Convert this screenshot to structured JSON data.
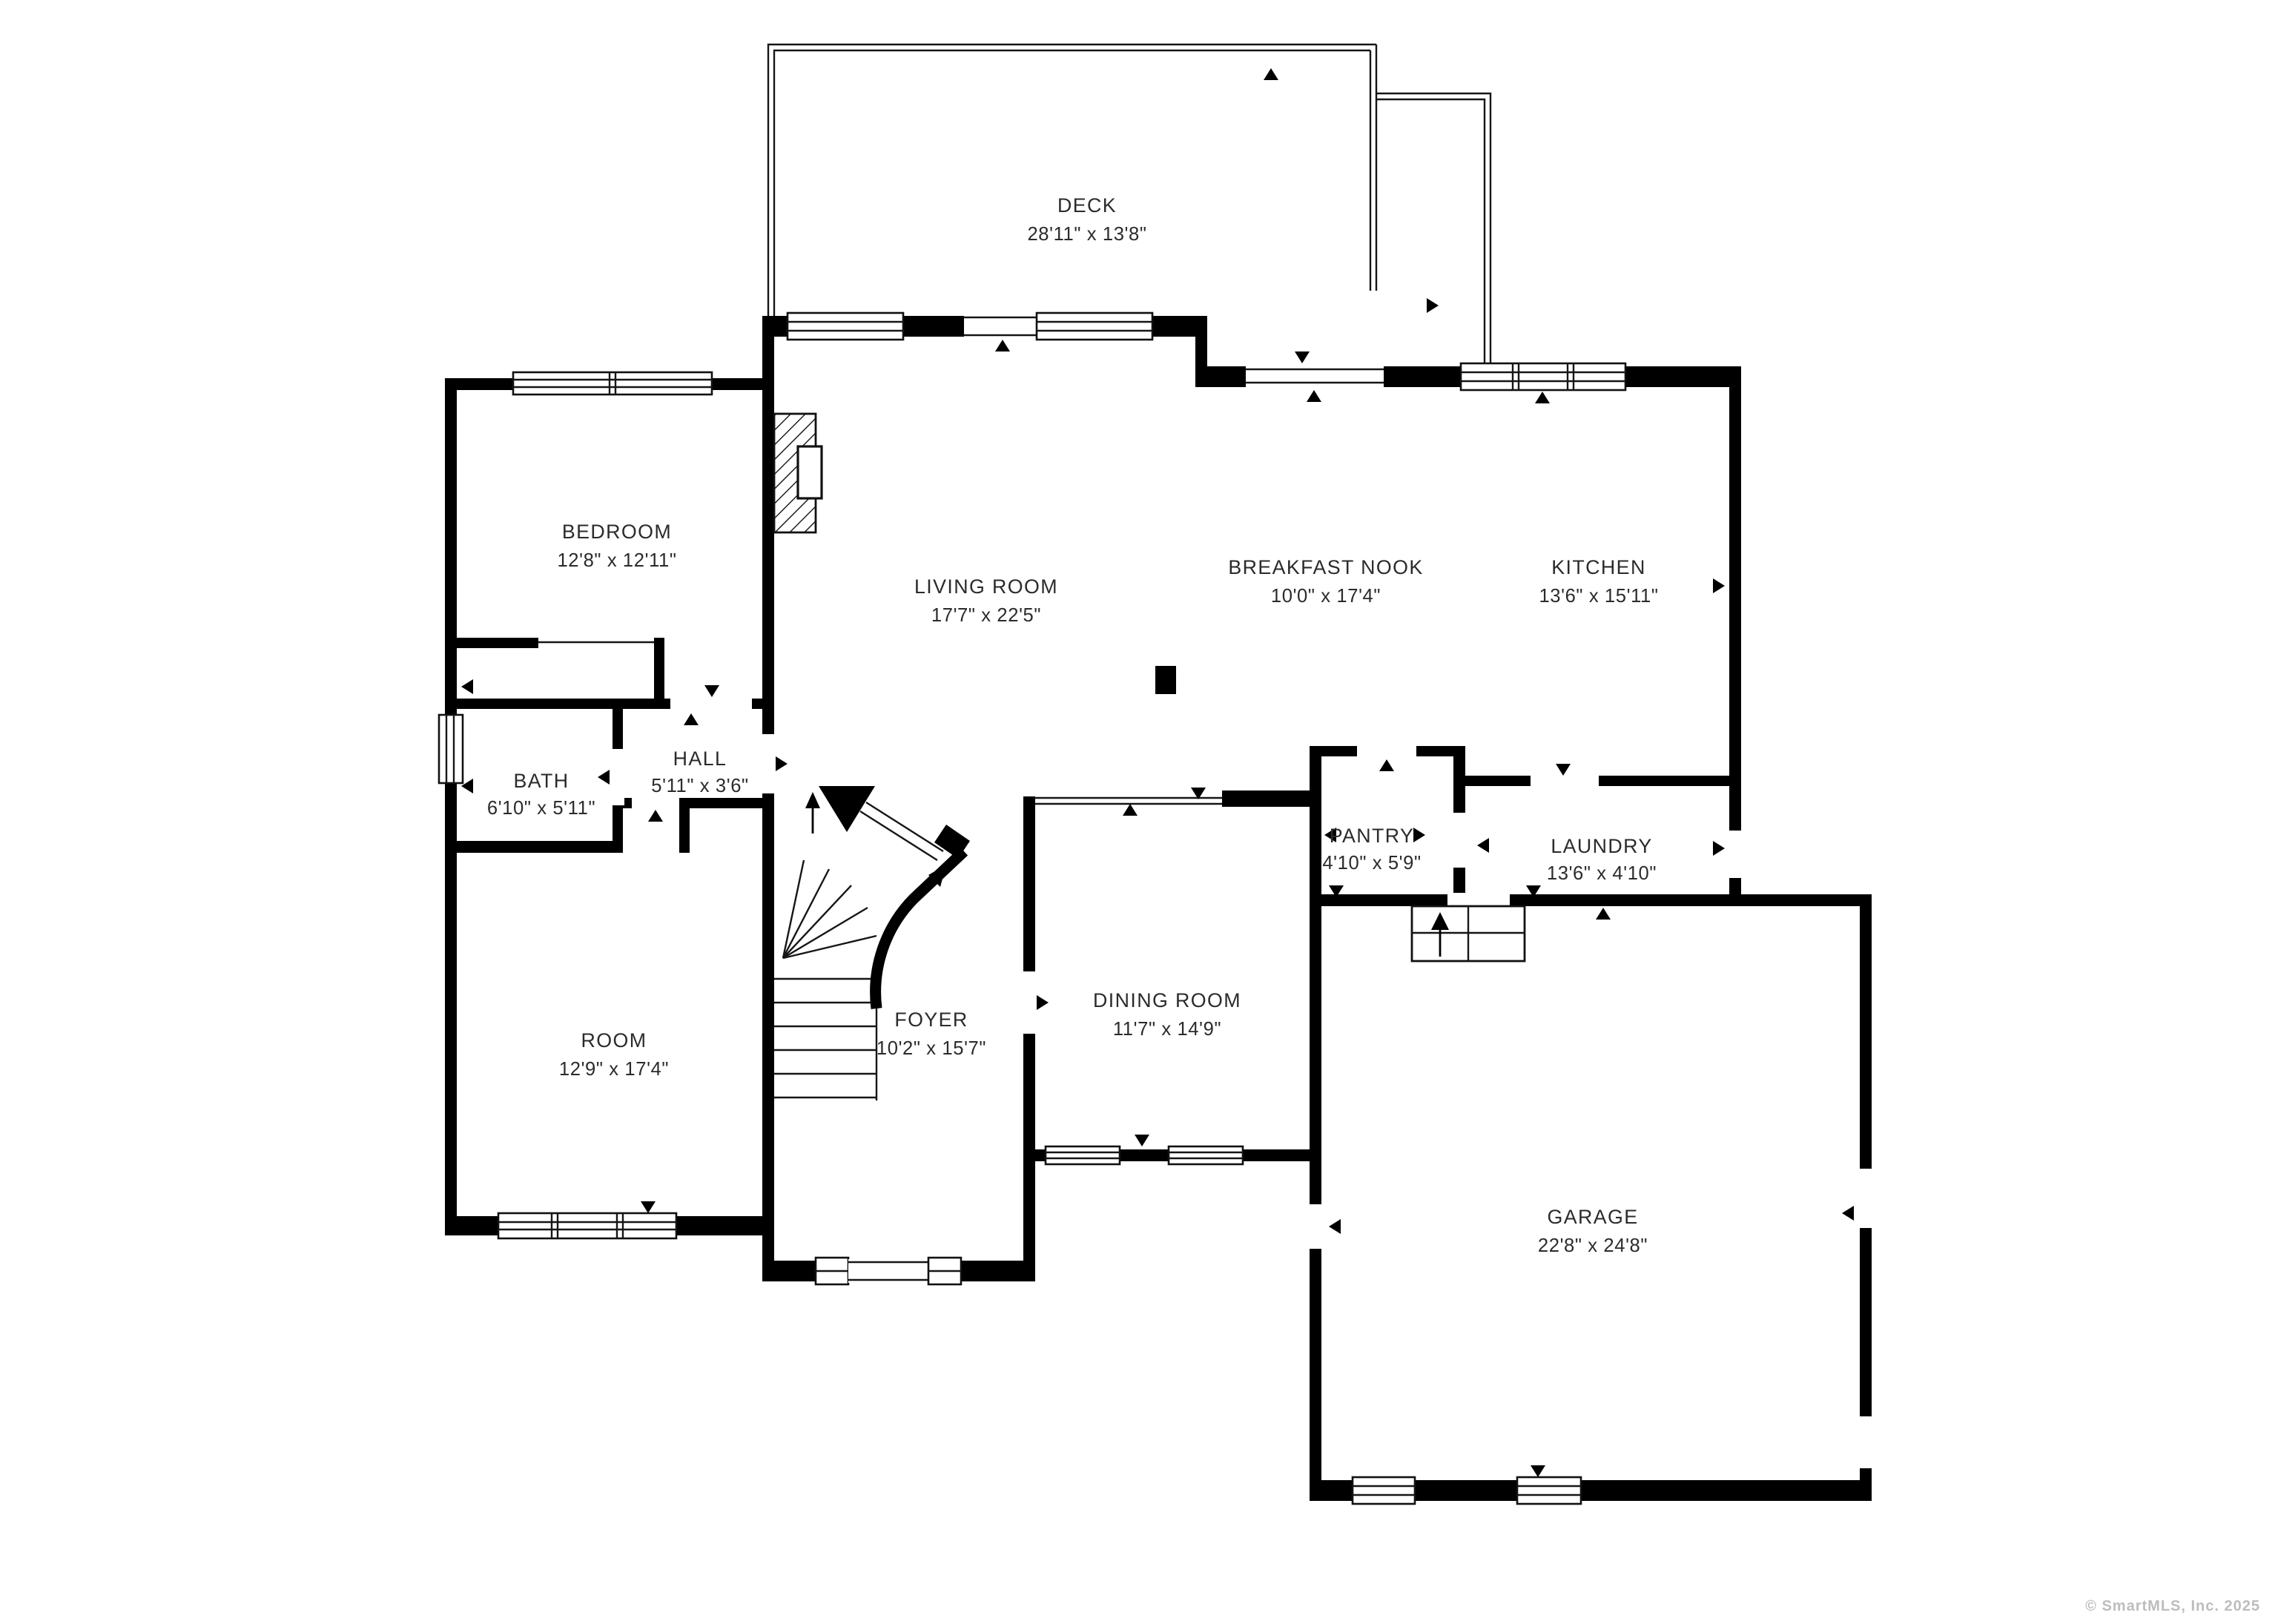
{
  "rooms": [
    {
      "name": "DECK",
      "dims": "28'11\" x 13'8\""
    },
    {
      "name": "BEDROOM",
      "dims": "12'8\" x 12'11\""
    },
    {
      "name": "LIVING ROOM",
      "dims": "17'7\" x 22'5\""
    },
    {
      "name": "BREAKFAST NOOK",
      "dims": "10'0\" x 17'4\""
    },
    {
      "name": "KITCHEN",
      "dims": "13'6\" x 15'11\""
    },
    {
      "name": "BATH",
      "dims": "6'10\" x 5'11\""
    },
    {
      "name": "HALL",
      "dims": "5'11\" x 3'6\""
    },
    {
      "name": "PANTRY",
      "dims": "4'10\" x 5'9\""
    },
    {
      "name": "LAUNDRY",
      "dims": "13'6\" x 4'10\""
    },
    {
      "name": "ROOM",
      "dims": "12'9\" x 17'4\""
    },
    {
      "name": "FOYER",
      "dims": "10'2\" x 15'7\""
    },
    {
      "name": "DINING ROOM",
      "dims": "11'7\" x 14'9\""
    },
    {
      "name": "GARAGE",
      "dims": "22'8\" x 24'8\""
    }
  ],
  "watermark": "© SmartMLS, Inc.  2025",
  "colors": {
    "wall": "#000000",
    "line": "#161616",
    "text": "#2b2b2b",
    "watermark": "#bdbdbd",
    "background": "#ffffff"
  }
}
